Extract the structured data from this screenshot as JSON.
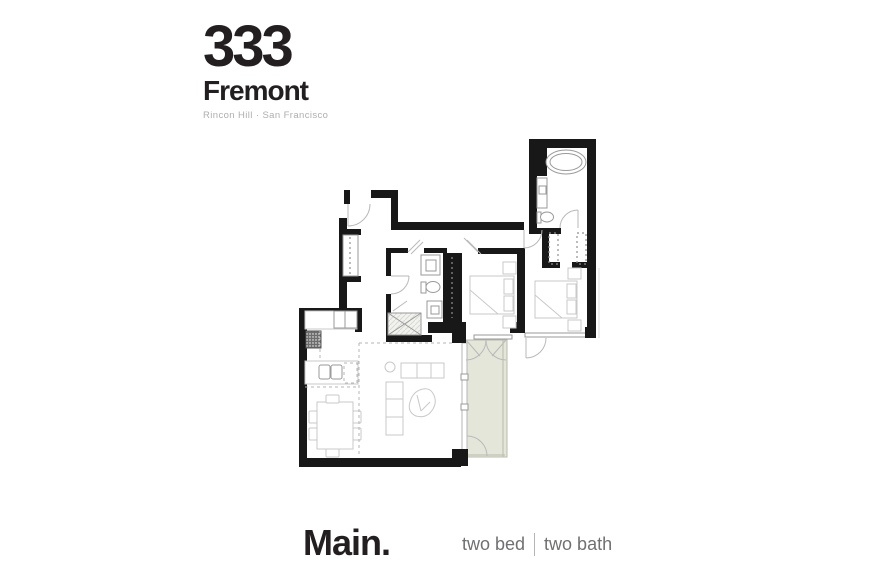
{
  "brand": {
    "number": "333",
    "name": "Fremont",
    "tagline": "Rincon Hill · San Francisco"
  },
  "footer": {
    "plan_name": "Main.",
    "bed_label": "two bed",
    "bath_label": "two bath"
  },
  "floor_plan": {
    "unit": "Main",
    "rooms_depicted": [
      "entry",
      "hall",
      "kitchen",
      "dining area",
      "living area",
      "balcony",
      "bedroom",
      "hall bathroom",
      "master bedroom",
      "walk-in closet",
      "master bathroom"
    ],
    "fixtures_depicted": [
      "bathtub",
      "toilet",
      "vanity sink",
      "shower",
      "range",
      "kitchen sink",
      "dishwasher",
      "dining table with six chairs",
      "sofa",
      "lounge chair",
      "media console",
      "side table",
      "beds with nightstands",
      "closet rods"
    ]
  },
  "colors": {
    "wall": "#181818",
    "balcony_fill": "#e4e6da",
    "balcony_line": "#b9bbae",
    "furniture_line": "#c9c9c9",
    "fixture_line": "#9a9a9a",
    "muted_text": "#aeaeae",
    "footer_text": "#6f7072"
  }
}
